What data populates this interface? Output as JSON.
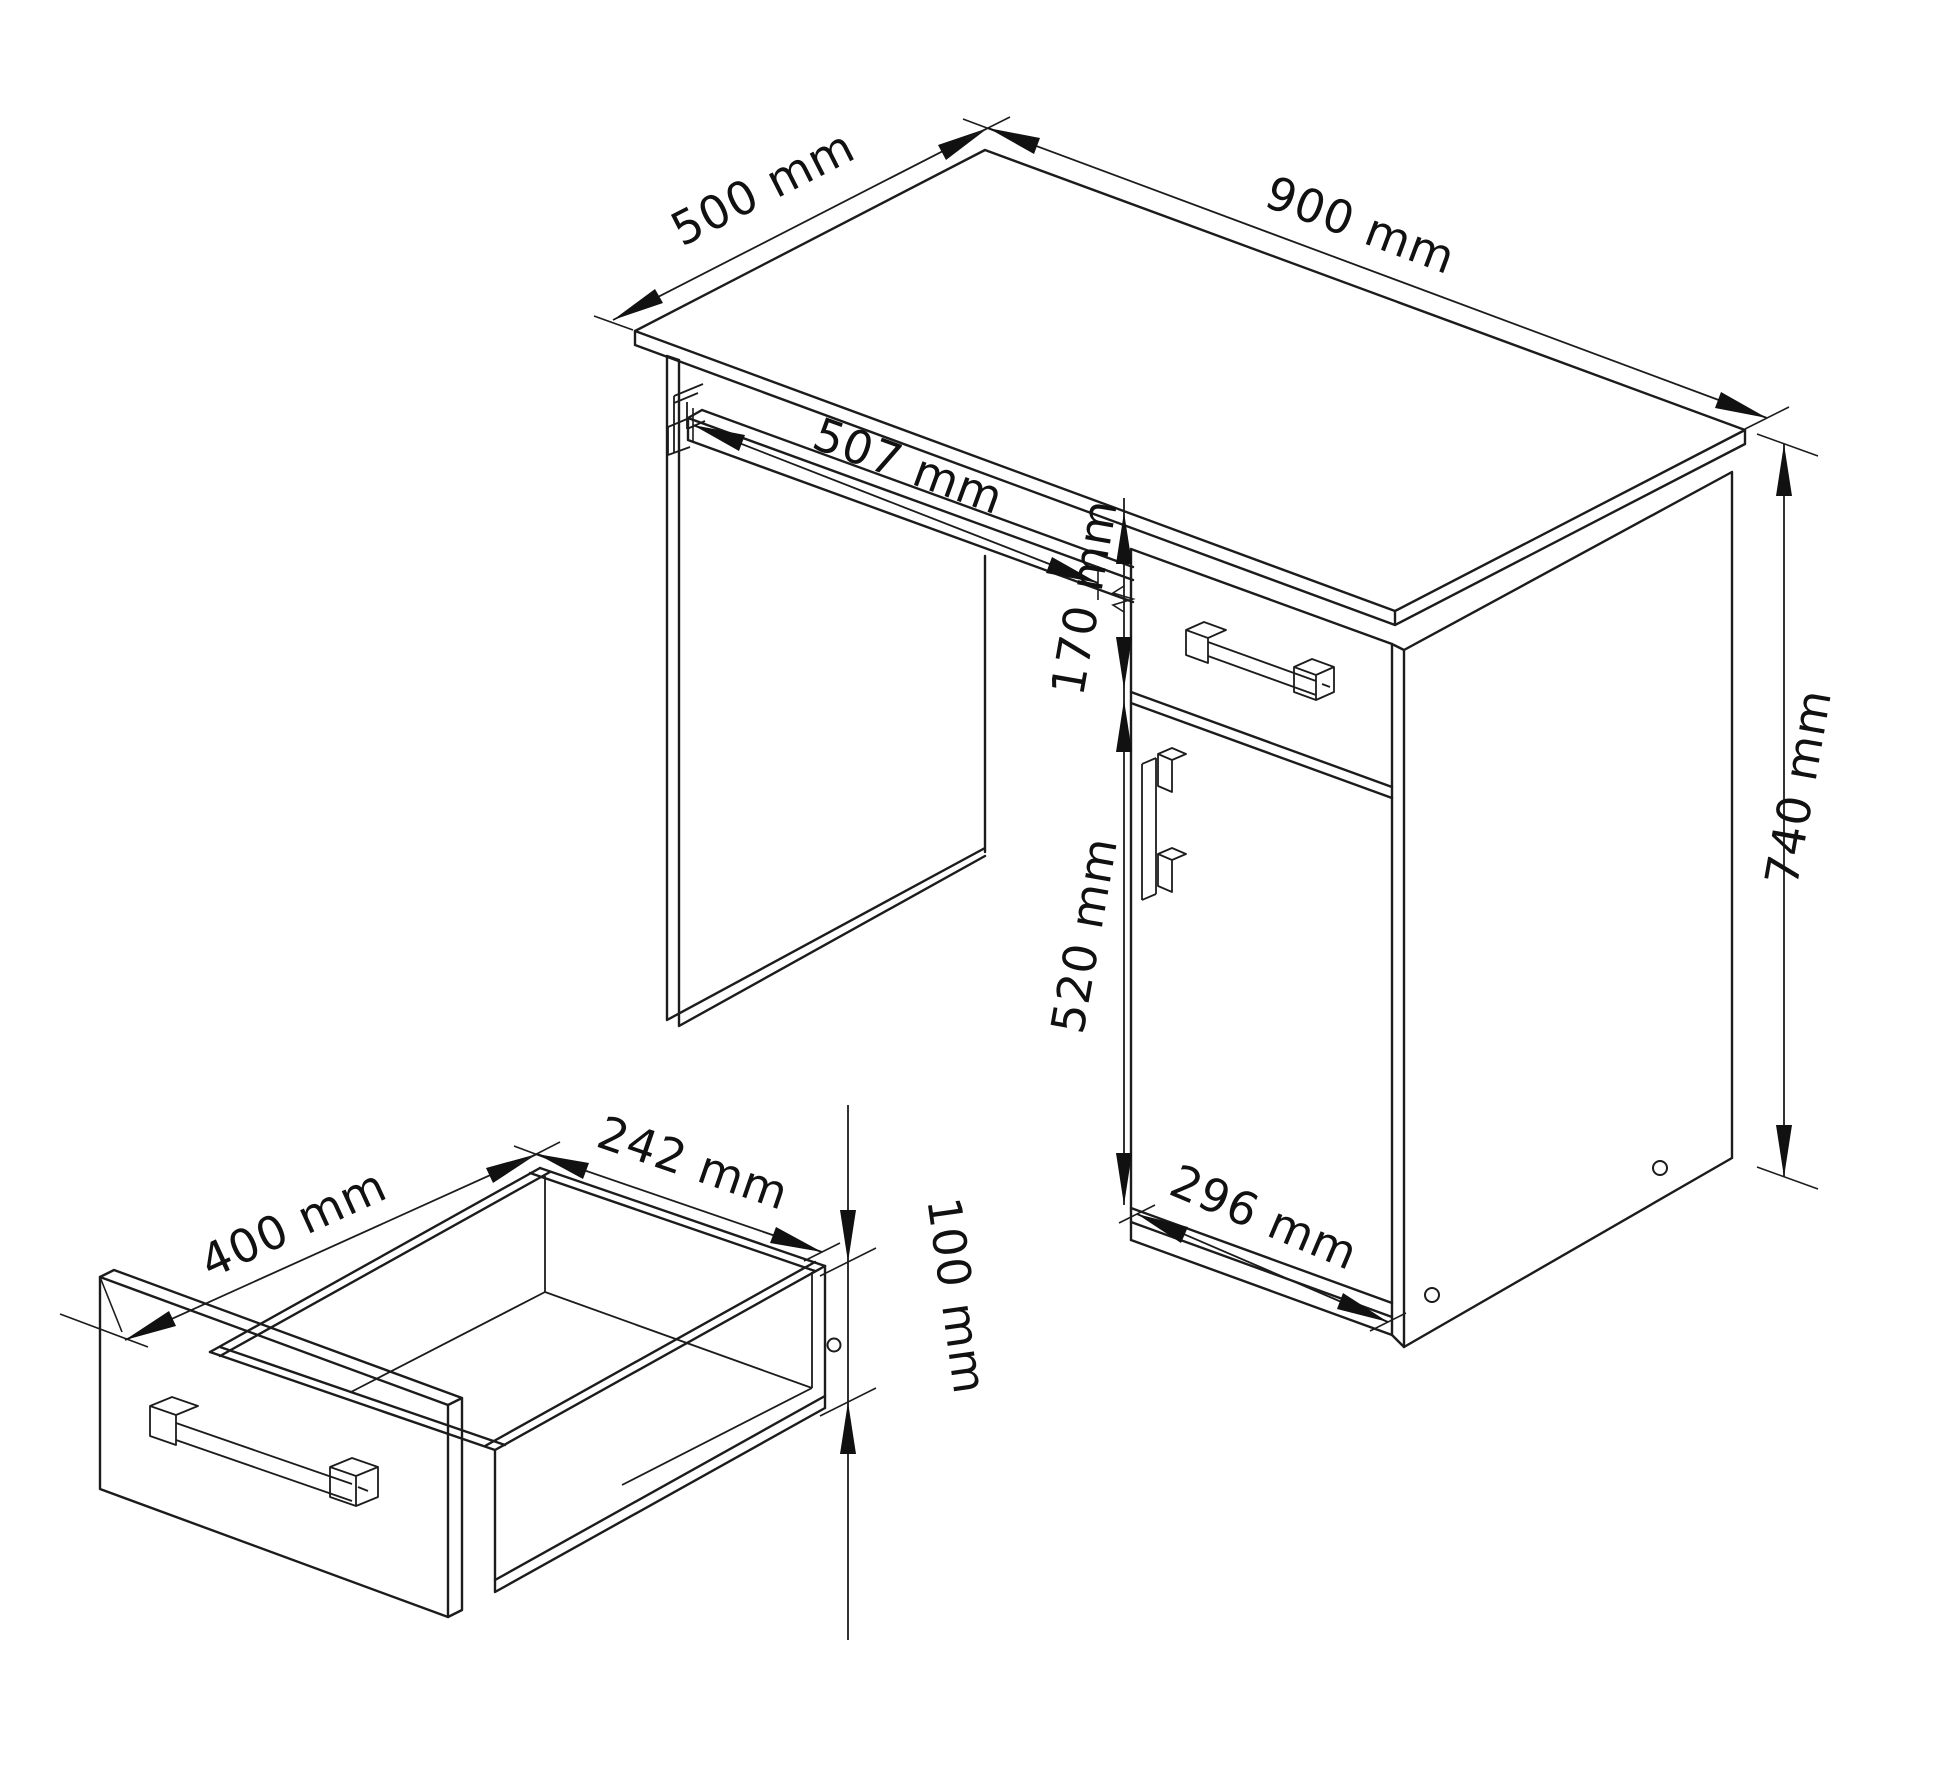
{
  "drawing": {
    "type": "furniture-technical-drawing",
    "subject": "desk with keyboard tray, drawer and cabinet door, plus pulled-out drawer detail",
    "units": "mm"
  },
  "dimensions": {
    "desk_depth": "500 mm",
    "desk_width": "900 mm",
    "tray_width": "507 mm",
    "drawer_front_height": "170 mm",
    "door_height": "520 mm",
    "desk_height": "740 mm",
    "cabinet_width": "296 mm",
    "drawer_depth": "400 mm",
    "drawer_inner_width": "242 mm",
    "drawer_box_height": "100 mm"
  },
  "colors": {
    "line": "#1c1c1c",
    "background": "#ffffff"
  }
}
